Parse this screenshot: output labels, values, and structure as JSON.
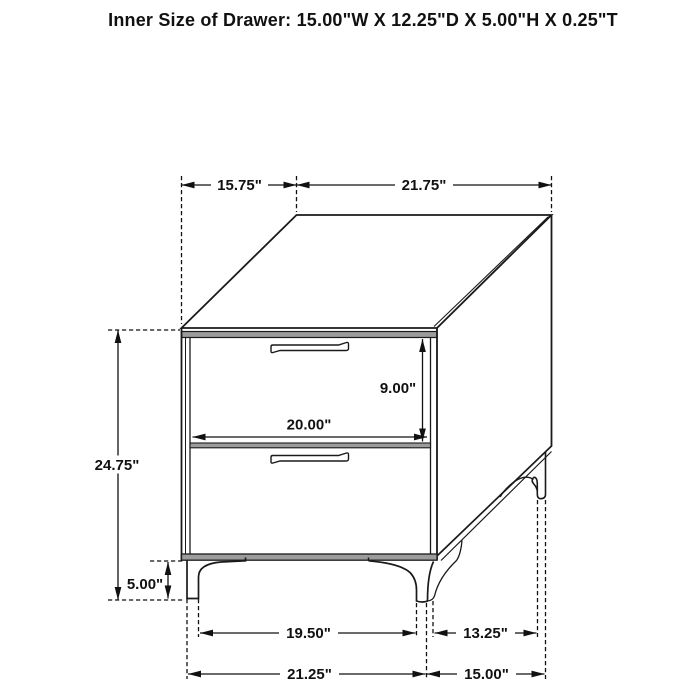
{
  "title": "Inner Size of Drawer: 15.00\"W X 12.25\"D X 5.00\"H X 0.25\"T",
  "dims": {
    "top_depth": "15.75\"",
    "top_width": "21.75\"",
    "drawer_front_height": "9.00\"",
    "drawer_front_width": "20.00\"",
    "overall_height": "24.75\"",
    "leg_height": "5.00\"",
    "front_leg_inner_span": "19.50\"",
    "side_leg_span": "13.25\"",
    "base_width": "21.25\"",
    "base_depth": "15.00\""
  },
  "colors": {
    "line": "#1a1a1a",
    "shade": "#9c9c9c",
    "text": "#111111",
    "background": "#ffffff"
  }
}
